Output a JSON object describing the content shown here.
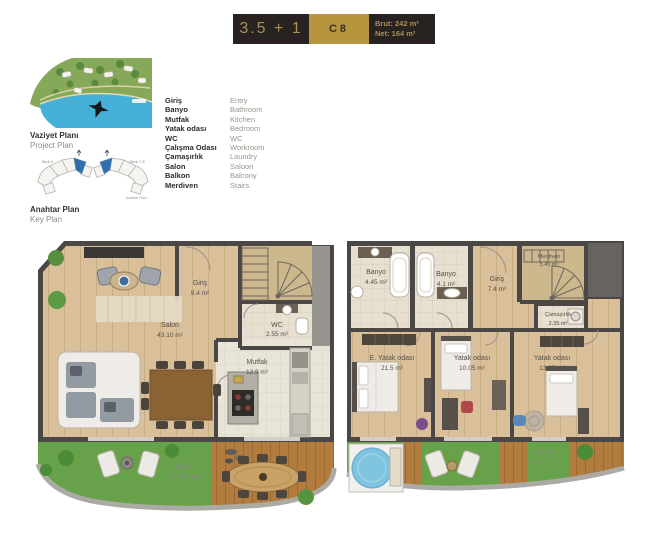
{
  "header": {
    "unit_type": "3.5 + 1",
    "unit_code": "C8",
    "brut": "Brut: 242 m²",
    "net": "Net: 164 m²"
  },
  "side": {
    "site_title": "Vaziyet Planı",
    "site_subtitle": "Project Plan",
    "key_title": "Anahtar Plan",
    "key_subtitle": "Key Plan",
    "block_left": "Blok 3",
    "block_right": "Blok 7-8",
    "key_caption": "Anahtar Planı"
  },
  "legend": {
    "items": [
      {
        "tr": "Giriş",
        "en": "Entry"
      },
      {
        "tr": "Banyo",
        "en": "Bathroom"
      },
      {
        "tr": "Mutfak",
        "en": "Kitchen"
      },
      {
        "tr": "Yatak odası",
        "en": "Bedroom"
      },
      {
        "tr": "WC",
        "en": "WC"
      },
      {
        "tr": "Çalışma Odası",
        "en": "Workroom"
      },
      {
        "tr": "Çamaşırlık",
        "en": "Laundry"
      },
      {
        "tr": "Salon",
        "en": "Saloon"
      },
      {
        "tr": "Balkon",
        "en": "Balcony"
      },
      {
        "tr": "Merdiven",
        "en": "Stairs"
      }
    ]
  },
  "floor1": {
    "salon": {
      "name": "Salon",
      "area": "43.10 m²"
    },
    "giris": {
      "name": "Giriş",
      "area": "9.4 m²"
    },
    "wc": {
      "name": "WC",
      "area": "2.55 m²"
    },
    "mutfak": {
      "name": "Mutfak",
      "area": "12.9 m²"
    },
    "balkon": {
      "name": "Balkon",
      "area": "(17.65 m²)"
    }
  },
  "floor2": {
    "banyo1": {
      "name": "Banyo",
      "area": "4.45 m²"
    },
    "banyo2": {
      "name": "Banyo",
      "area": "4.1 m²"
    },
    "giris": {
      "name": "Giriş",
      "area": "7.4 m²"
    },
    "merdiven": {
      "name": "Merdiven",
      "area": "5.45 m²"
    },
    "camasirlik": {
      "name": "Çamaşırlık",
      "area": "2.35 m²"
    },
    "e_yatak": {
      "name": "E. Yatak odası",
      "area": "21.5 m²"
    },
    "yatak2": {
      "name": "Yatak odası",
      "area": "10.05 m²"
    },
    "yatak3": {
      "name": "Yatak odası",
      "area": "13.25 m²"
    },
    "balkon": {
      "name": "Balkon",
      "area": "(11.35 m²)"
    }
  },
  "colors": {
    "gold": "#b6953e",
    "header_dark": "#282321",
    "wall": "#4b4744",
    "wood": "#d9c09a",
    "grass": "#67a24b",
    "deck": "#b17c3e",
    "water": "#45b0d8",
    "key_unit_blue": "#2f6fae"
  }
}
